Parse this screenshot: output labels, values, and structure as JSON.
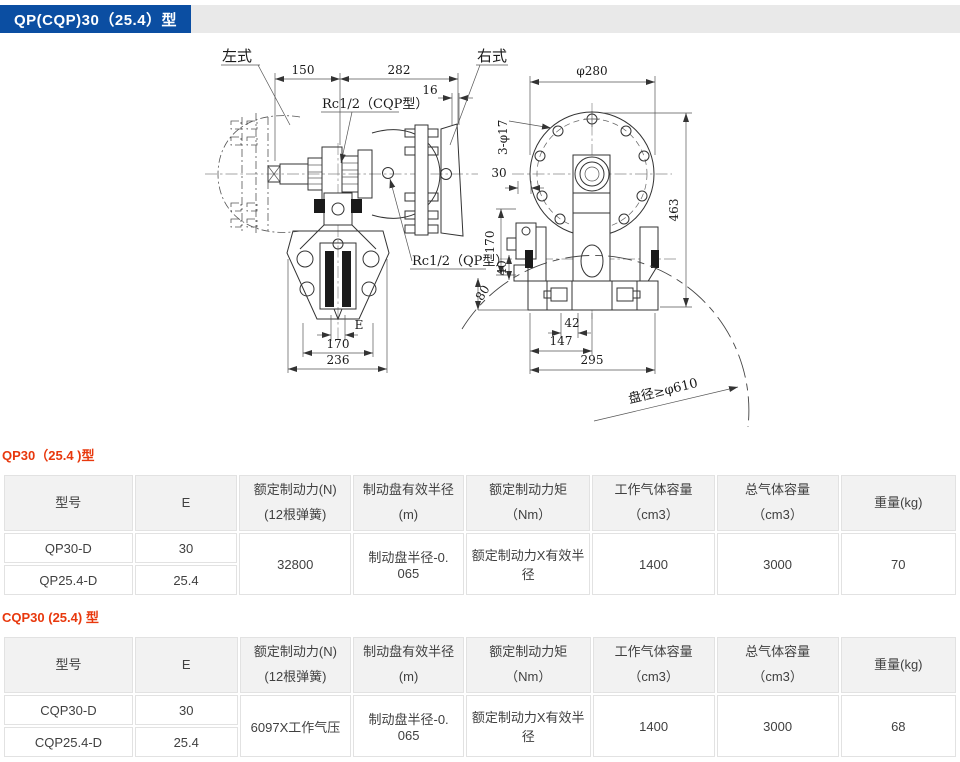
{
  "header": {
    "title": "QP(CQP)30（25.4）型",
    "bar_color": "#0b4ea2",
    "strip_color": "#e9e9e9",
    "text_color": "#ffffff"
  },
  "drawing": {
    "view_left": {
      "label_left": "左式",
      "label_right": "右式",
      "rc_cqp": "Rc1/2（CQP型）",
      "rc_qp": "Rc1/2（QP型）",
      "d150": "150",
      "d282": "282",
      "d16": "16",
      "dE": "E",
      "d170": "170",
      "d236": "236"
    },
    "view_right": {
      "dia": "φ280",
      "holes": "3-φ17",
      "d30": "30",
      "d170": "170",
      "d40": "40",
      "d80": "80",
      "d463": "463",
      "d42": "42",
      "d147": "147",
      "d295": "295",
      "disc": "盘径≥φ610"
    }
  },
  "accent": {
    "label_red": "#e8380d",
    "line_dark": "#333333"
  },
  "tables": [
    {
      "section_label": "QP30（25.4 )型",
      "headers": [
        "型号",
        "E",
        "额定制动力(N) (12根弹簧)",
        "制动盘有效半径(m)",
        "额定制动力矩（Nm）",
        "工作气体容量（cm3）",
        "总气体容量（cm3）",
        "重量(kg)"
      ],
      "rows": [
        {
          "model": "QP30-D",
          "e": "30"
        },
        {
          "model": "QP25.4-D",
          "e": "25.4"
        }
      ],
      "merged": {
        "force": "32800",
        "radius": "制动盘半径-0. 065",
        "torque": "额定制动力X有效半径",
        "work_vol": "1400",
        "total_vol": "3000",
        "weight": "70"
      }
    },
    {
      "section_label": "CQP30 (25.4) 型",
      "headers": [
        "型号",
        "E",
        "额定制动力(N) (12根弹簧)",
        "制动盘有效半径(m)",
        "额定制动力矩（Nm）",
        "工作气体容量（cm3）",
        "总气体容量（cm3）",
        "重量(kg)"
      ],
      "rows": [
        {
          "model": "CQP30-D",
          "e": "30"
        },
        {
          "model": "CQP25.4-D",
          "e": "25.4"
        }
      ],
      "merged": {
        "force": "6097X工作气压",
        "radius": "制动盘半径-0. 065",
        "torque": "额定制动力X有效半径",
        "work_vol": "1400",
        "total_vol": "3000",
        "weight": "68"
      }
    }
  ]
}
